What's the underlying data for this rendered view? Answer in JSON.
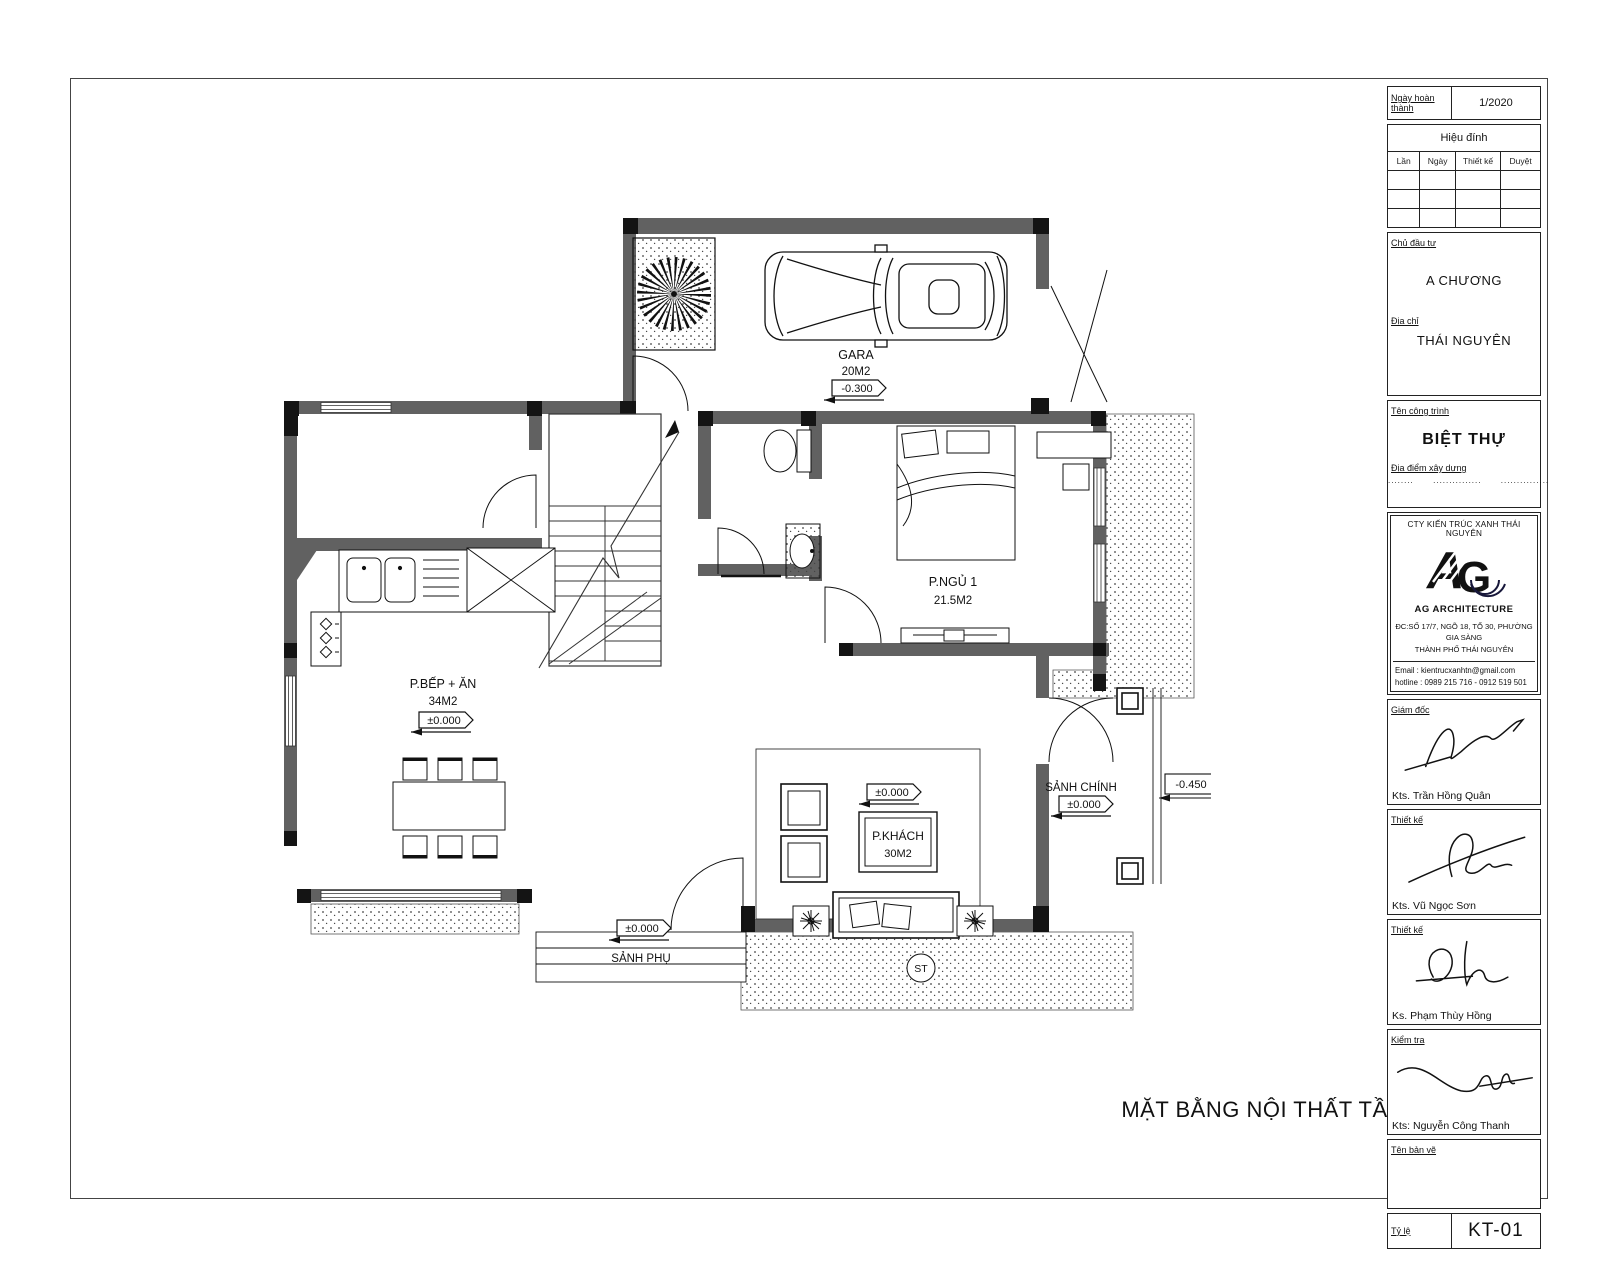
{
  "title_block": {
    "date_label": "Ngày hoàn thành",
    "date_value": "1/2020",
    "revision": {
      "title": "Hiệu đính",
      "columns": [
        "Lần",
        "Ngày",
        "Thiết kế",
        "Duyệt"
      ]
    },
    "client_label": "Chủ đầu tư",
    "client": "A CHƯƠNG",
    "address_label": "Địa chỉ",
    "address": "THÁI NGUYÊN",
    "project_label": "Tên công trình",
    "project": "BIỆT THỰ",
    "site_label": "Địa điểm xây dựng",
    "site_dots": "........      ...............      ...............",
    "company": {
      "name": "CTY KIẾN TRÚC XANH THÁI NGUYÊN",
      "brand": "AG ARCHITECTURE",
      "addr1": "ĐC:SỐ 17/7, NGÕ 18, TỔ 30, PHƯỜNG GIA SÀNG",
      "addr2": "THÀNH PHỐ THÁI NGUYÊN",
      "email": "Email : kientrucxanhtn@gmail.com",
      "hotline": "hotline : 0989 215 716 - 0912 519 501"
    },
    "signers": [
      {
        "role": "Giám đốc",
        "name": "Kts. Trần Hồng Quân"
      },
      {
        "role": "Thiết kế",
        "name": "Kts. Vũ Ngọc Sơn"
      },
      {
        "role": "Thiết kế",
        "name": "Ks. Phạm Thùy Hồng"
      },
      {
        "role": "Kiểm tra",
        "name": "Kts: Nguyễn Công Thanh"
      }
    ],
    "drawing_name_label": "Tên bản vẽ",
    "scale_label": "Tỷ lệ",
    "sheet_number": "KT-01"
  },
  "plan": {
    "title": "MẶT BẰNG NỘI THẤT TẦNG 1",
    "rooms": {
      "garage": {
        "name": "GARA",
        "area": "20M2",
        "level": "-0.300"
      },
      "bedroom": {
        "name": "P.NGỦ 1",
        "area": "21.5M2"
      },
      "kitchen": {
        "name": "P.BẾP + ĂN",
        "area": "34M2",
        "level": "±0.000"
      },
      "living": {
        "name": "P.KHÁCH",
        "area": "30M2",
        "level": "±0.000"
      },
      "main_hall": {
        "name": "SẢNH CHÍNH",
        "level": "±0.000"
      },
      "side_hall": {
        "name": "SẢNH PHỤ",
        "level": "±0.000"
      }
    },
    "outside_level": "-0.450",
    "step_mark": "ST"
  }
}
